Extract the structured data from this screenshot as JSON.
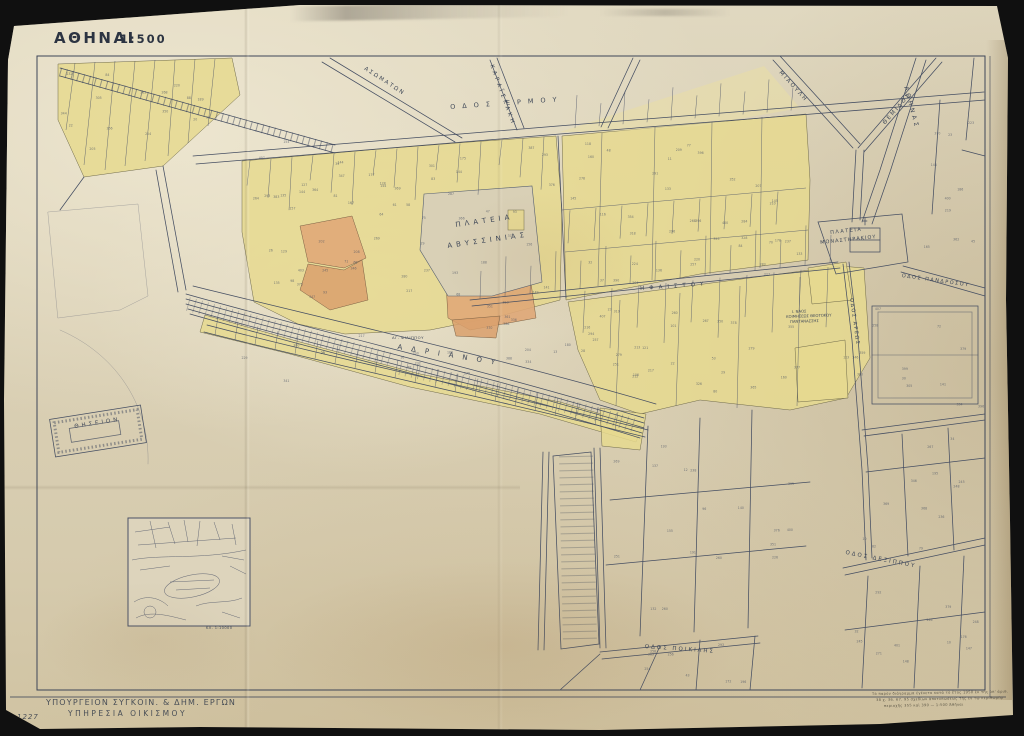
{
  "document": {
    "received_note": "Rec'd. Sept. 24, 1952",
    "title": "ΑΘΗΝΑΙ",
    "scale": "1:500",
    "sheet_number": "Δ 1227",
    "agency": {
      "line1": "ΥΠΟΥΡΓΕΙΟΝ ΣΥΓΚΟΙΝ. & ΔΗΜ. ΕΡΓΩΝ",
      "line2": "ΥΠΗΡΕΣΙΑ ΟΙΚΙΣΜΟΥ"
    },
    "fineprint": [
      "Τὸ παρὸν διάγραμμα ἐγένετο κατὰ τὸ ἔτος 1950 ἐκ τῆς ὑπ' ἀριθ.",
      "38 χ. 36. 67. 95 σχεδίων ἀποτυπώσεως τῆς ἐν τῷ περιθωρίῳ",
      "περιοχῆς 355 καὶ 390 — 1:500 Ἀθῆναι"
    ],
    "inset_caption": "ΚΛ. 1:10000"
  },
  "labels": {
    "squares": {
      "avissinias": [
        "ΠΛΑΤΕΙΑ",
        "ΑΒΥΣΣΙΝΙΑΣ"
      ],
      "monastirakiou": [
        "ΠΛΑΤΕΙΑ",
        "ΜΟΝΑΣΤΗΡΑΚΙΟΥ"
      ]
    },
    "streets": {
      "ermou": "ΟΔΟΣ ΕΡΜΟΥ",
      "adrianou": "ΑΔΡΙΑΝΟΥ",
      "karaiskaki": "ΚΑΡΑΪΣΚΑΚΗ",
      "asomaton": "ΑΣΩΜΑΤΩΝ",
      "miaouli": "ΜΙΑΟΥΛΗ",
      "themidos": "ΘΕΜΙΔΟΣ",
      "athinas": "ΑΘΗΝΑΣ",
      "ifestou": "ΗΦΑΙΣΤΟΥ",
      "areos": "ΟΔΟΣ ΑΡΕΩΣ",
      "pandrosou": "ΟΔΟΣ ΠΑΝΔΡΟΣΟΥ",
      "poikilis": "ΟΔΟΣ ΠΟΙΚΙΛΗΣ",
      "dexippou": "ΟΔΟΣ ΔΕΞΙΠΠΟΥ"
    },
    "landmarks": {
      "thiseion": "ΘΗΣΕΙΟΝ",
      "church": [
        "Ι. ΝΑΟΣ",
        "ΚΟΙΜΗΣΕΩΣ ΘΕΟΤΟΚΟΥ",
        "ΠΑΝΤΑΝΑΣΣΗΣ"
      ],
      "ag_filippos": "ΑΓ. ΦΙΛΙΠΠΟΥ"
    }
  },
  "colors": {
    "paper": "#d9cfb4",
    "block_yellow": "#e6d98f",
    "block_orange": "#e0a878",
    "linework": "#454e62",
    "background": "#101010"
  }
}
